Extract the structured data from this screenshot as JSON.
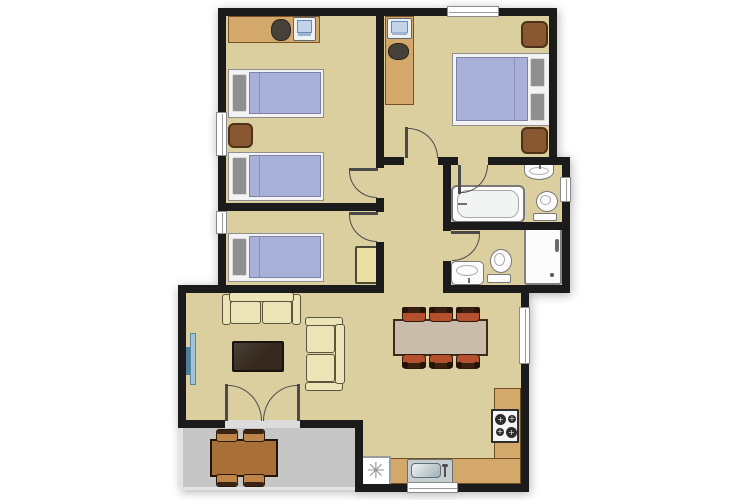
{
  "meta": {
    "view": "apartment-floor-plan",
    "canvas": {
      "width": 750,
      "height": 500
    }
  },
  "palette": {
    "floor": "#dbcfa0",
    "wall": "#1b1b1b",
    "patio": "#c6c6c6",
    "door_line": "#4a4a4a",
    "threshold": "#dcdcdc",
    "bed_duvet": "#a9b0d8",
    "bed_pillow": "#8f8f8f",
    "bed_frame": "#f3f3f3",
    "wood": "#d4a76a",
    "nightstand": "#8a5733",
    "cabinet": "#eae0a4",
    "sofa": "#ece4b6",
    "coffee_table": "#35291f",
    "dining_table_wood": "#cabcab",
    "dining_chair": "#b5502f",
    "patio_table_wood": "#a86f38",
    "patio_chair": "#bf8448",
    "fixture": "#fcfcfc",
    "fixture_line": "#787878",
    "tv_light": "#9fc6d8",
    "tv_dark": "#4f7f9f",
    "sink_metal": "#c7ced1"
  },
  "icons": {
    "freezer": "freezer-asterisk-icon"
  },
  "rooms": [
    {
      "name": "bedroom-1",
      "kind": "room",
      "rect": [
        226,
        16,
        150,
        187
      ]
    },
    {
      "name": "bedroom-2",
      "kind": "room",
      "rect": [
        226,
        211,
        150,
        74
      ]
    },
    {
      "name": "master-bedroom",
      "kind": "room",
      "rect": [
        384,
        16,
        165,
        141
      ]
    },
    {
      "name": "hallway",
      "kind": "room",
      "rect": [
        384,
        165,
        59,
        128
      ]
    },
    {
      "name": "ensuite-bathroom",
      "kind": "room",
      "rect": [
        451,
        165,
        111,
        57
      ]
    },
    {
      "name": "bathroom",
      "kind": "room",
      "rect": [
        451,
        230,
        111,
        55
      ]
    },
    {
      "name": "living-dining-room",
      "kind": "room",
      "rect": [
        186,
        293,
        335,
        127
      ]
    },
    {
      "name": "kitchen",
      "kind": "room",
      "rect": [
        363,
        420,
        158,
        64
      ]
    },
    {
      "name": "patio",
      "kind": "patio",
      "rect": [
        180,
        428,
        175,
        62
      ]
    }
  ],
  "walls": [
    {
      "name": "outer-top",
      "rect": [
        218,
        8,
        339,
        8
      ]
    },
    {
      "name": "outer-left",
      "rect": [
        218,
        8,
        8,
        285
      ]
    },
    {
      "name": "master-east",
      "rect": [
        549,
        8,
        8,
        154
      ]
    },
    {
      "name": "master-south",
      "rect": [
        376,
        157,
        194,
        8
      ]
    },
    {
      "name": "bath-east",
      "rect": [
        562,
        157,
        8,
        136
      ]
    },
    {
      "name": "bath-south",
      "rect": [
        443,
        285,
        127,
        8
      ]
    },
    {
      "name": "hall-west",
      "rect": [
        376,
        8,
        8,
        285
      ]
    },
    {
      "name": "bedroom-divider",
      "rect": [
        226,
        203,
        150,
        8
      ]
    },
    {
      "name": "living-north",
      "rect": [
        178,
        285,
        206,
        8
      ]
    },
    {
      "name": "living-west",
      "rect": [
        178,
        285,
        8,
        143
      ]
    },
    {
      "name": "living-south",
      "rect": [
        178,
        420,
        185,
        8
      ]
    },
    {
      "name": "kitchen-step",
      "rect": [
        355,
        420,
        8,
        72
      ]
    },
    {
      "name": "kitchen-south",
      "rect": [
        355,
        484,
        174,
        8
      ]
    },
    {
      "name": "east-lower",
      "rect": [
        521,
        285,
        8,
        207
      ]
    },
    {
      "name": "bath-west",
      "rect": [
        443,
        165,
        8,
        120
      ]
    },
    {
      "name": "bath-divider",
      "rect": [
        451,
        222,
        111,
        8
      ]
    }
  ],
  "windows": [
    {
      "name": "bedroom-1-west",
      "orient": "v",
      "rect": [
        216,
        112,
        11,
        44
      ]
    },
    {
      "name": "bedroom-2-west",
      "orient": "v",
      "rect": [
        216,
        211,
        11,
        23
      ]
    },
    {
      "name": "master-north",
      "orient": "h",
      "rect": [
        447,
        6,
        52,
        11
      ]
    },
    {
      "name": "ensuite-east",
      "orient": "v",
      "rect": [
        560,
        177,
        11,
        25
      ]
    },
    {
      "name": "dining-east",
      "orient": "v",
      "rect": [
        519,
        307,
        11,
        57
      ]
    },
    {
      "name": "kitchen-south",
      "orient": "h",
      "rect": [
        407,
        482,
        51,
        11
      ]
    }
  ],
  "doors": [
    {
      "name": "bedroom-1",
      "gap": [
        376,
        168,
        8,
        30
      ],
      "leaf": [
        349,
        168,
        29,
        3
      ],
      "arc": [
        349,
        171,
        28,
        27
      ],
      "corner": "bl"
    },
    {
      "name": "bedroom-2",
      "gap": [
        376,
        212,
        8,
        30
      ],
      "leaf": [
        349,
        212,
        29,
        3
      ],
      "arc": [
        349,
        215,
        28,
        27
      ],
      "corner": "bl"
    },
    {
      "name": "master-bedroom",
      "gap": [
        404,
        157,
        34,
        8
      ],
      "leaf": [
        405,
        127,
        3,
        31
      ],
      "arc": [
        408,
        128,
        30,
        30
      ],
      "corner": "tr"
    },
    {
      "name": "ensuite",
      "gap": [
        458,
        157,
        30,
        8
      ],
      "leaf": [
        458,
        165,
        3,
        29
      ],
      "arc": [
        461,
        165,
        27,
        28
      ],
      "corner": "br"
    },
    {
      "name": "bathroom",
      "gap": [
        443,
        231,
        8,
        30
      ],
      "leaf": [
        451,
        231,
        29,
        3
      ],
      "arc": [
        452,
        234,
        28,
        27
      ],
      "corner": "br"
    },
    {
      "name": "patio-french-left",
      "gap": [
        225,
        420,
        75,
        8
      ],
      "gap_color": "#dcdcdc",
      "leaf": [
        225,
        384,
        3,
        37
      ],
      "arc": [
        228,
        385,
        34,
        36
      ],
      "corner": "tr"
    },
    {
      "name": "patio-french-right",
      "gap": null,
      "leaf": [
        297,
        384,
        3,
        37
      ],
      "arc": [
        263,
        385,
        34,
        36
      ],
      "corner": "tl"
    }
  ],
  "furniture": [
    {
      "type": "desk",
      "name": "desk-bedroom-1",
      "rect": [
        228,
        16,
        92,
        27
      ],
      "opts": {
        "lines": "h"
      }
    },
    {
      "type": "computer",
      "name": "computer-bedroom-1",
      "rect": [
        293,
        17,
        23,
        24
      ],
      "opts": {}
    },
    {
      "type": "chair-blob",
      "name": "desk-chair-bedroom-1",
      "rect": [
        271,
        19,
        20,
        22
      ],
      "opts": {}
    },
    {
      "type": "bed-single",
      "name": "single-bed-1",
      "rect": [
        228,
        69,
        96,
        49
      ],
      "opts": {}
    },
    {
      "type": "nightstand",
      "name": "nightstand-bedroom-1",
      "rect": [
        228,
        123,
        25,
        25
      ],
      "opts": {}
    },
    {
      "type": "bed-single",
      "name": "single-bed-2",
      "rect": [
        228,
        152,
        96,
        49
      ],
      "opts": {}
    },
    {
      "type": "bed-single",
      "name": "single-bed-3",
      "rect": [
        228,
        233,
        96,
        49
      ],
      "opts": {}
    },
    {
      "type": "cabinet",
      "name": "cabinet-bedroom-2",
      "rect": [
        355,
        246,
        25,
        38
      ],
      "opts": {}
    },
    {
      "type": "desk",
      "name": "desk-master",
      "rect": [
        385,
        16,
        29,
        89
      ],
      "opts": {
        "lines": "h"
      }
    },
    {
      "type": "computer",
      "name": "computer-master",
      "rect": [
        387,
        18,
        25,
        21
      ],
      "opts": {}
    },
    {
      "type": "chair-blob",
      "name": "desk-chair-master",
      "rect": [
        388,
        43,
        21,
        17
      ],
      "opts": {}
    },
    {
      "type": "bed-double",
      "name": "double-bed",
      "rect": [
        452,
        53,
        98,
        73
      ],
      "opts": {}
    },
    {
      "type": "nightstand",
      "name": "nightstand-master-north",
      "rect": [
        521,
        21,
        27,
        27
      ],
      "opts": {}
    },
    {
      "type": "nightstand",
      "name": "nightstand-master-south",
      "rect": [
        521,
        127,
        27,
        27
      ],
      "opts": {}
    },
    {
      "type": "bathtub",
      "name": "bathtub",
      "rect": [
        451,
        185,
        74,
        38
      ],
      "opts": {}
    },
    {
      "type": "sink-wall",
      "name": "ensuite-sink",
      "rect": [
        524,
        163,
        30,
        17
      ],
      "opts": {}
    },
    {
      "type": "toilet",
      "name": "ensuite-toilet",
      "rect": [
        533,
        191,
        27,
        32
      ],
      "opts": {}
    },
    {
      "type": "shower",
      "name": "shower",
      "rect": [
        524,
        228,
        38,
        57
      ],
      "opts": {}
    },
    {
      "type": "toilet",
      "name": "bathroom-toilet",
      "rect": [
        487,
        249,
        27,
        36
      ],
      "opts": {}
    },
    {
      "type": "sink-pedestal",
      "name": "bathroom-sink",
      "rect": [
        451,
        261,
        33,
        24
      ],
      "opts": {}
    },
    {
      "type": "sofa",
      "name": "sofa-main",
      "rect": [
        222,
        292,
        79,
        35
      ],
      "opts": {
        "back": "top"
      }
    },
    {
      "type": "sofa",
      "name": "sofa-side",
      "rect": [
        303,
        317,
        42,
        74
      ],
      "opts": {
        "back": "right"
      }
    },
    {
      "type": "block",
      "name": "tv-screen",
      "rect": [
        186,
        347,
        4,
        28
      ],
      "opts": {
        "color": "#4f7f9f"
      }
    },
    {
      "type": "block",
      "name": "tv-unit",
      "rect": [
        190,
        333,
        6,
        52
      ],
      "opts": {
        "color": "#9fc6d8",
        "border": "#5a87a0"
      }
    },
    {
      "type": "coffee-table",
      "name": "coffee-table",
      "rect": [
        232,
        341,
        52,
        31
      ],
      "opts": {}
    },
    {
      "type": "dining-table",
      "name": "dining-table",
      "rect": [
        393,
        319,
        95,
        37
      ],
      "opts": {}
    },
    {
      "type": "chair-dining",
      "name": "dining-chair-1",
      "rect": [
        402,
        307,
        24,
        15
      ],
      "opts": {
        "cap": "top"
      }
    },
    {
      "type": "chair-dining",
      "name": "dining-chair-2",
      "rect": [
        429,
        307,
        24,
        15
      ],
      "opts": {
        "cap": "top"
      }
    },
    {
      "type": "chair-dining",
      "name": "dining-chair-3",
      "rect": [
        456,
        307,
        24,
        15
      ],
      "opts": {
        "cap": "top"
      }
    },
    {
      "type": "chair-dining",
      "name": "dining-chair-4",
      "rect": [
        402,
        354,
        24,
        15
      ],
      "opts": {
        "cap": "bottom"
      }
    },
    {
      "type": "chair-dining",
      "name": "dining-chair-5",
      "rect": [
        429,
        354,
        24,
        15
      ],
      "opts": {
        "cap": "bottom"
      }
    },
    {
      "type": "chair-dining",
      "name": "dining-chair-6",
      "rect": [
        456,
        354,
        24,
        15
      ],
      "opts": {
        "cap": "bottom"
      }
    },
    {
      "type": "counter",
      "name": "kitchen-counter-east",
      "rect": [
        494,
        388,
        27,
        71
      ],
      "opts": {
        "lines": "h"
      }
    },
    {
      "type": "counter",
      "name": "kitchen-counter-south",
      "rect": [
        389,
        458,
        132,
        26
      ],
      "opts": {
        "lines": "v"
      }
    },
    {
      "type": "stove",
      "name": "stove",
      "rect": [
        491,
        409,
        28,
        34
      ],
      "opts": {}
    },
    {
      "type": "kitchen-sink",
      "name": "kitchen-sink",
      "rect": [
        407,
        459,
        46,
        25
      ],
      "opts": {}
    },
    {
      "type": "freezer",
      "name": "freezer",
      "rect": [
        361,
        456,
        30,
        31
      ],
      "opts": {
        "glyph": "✳"
      }
    },
    {
      "type": "patio-table",
      "name": "patio-table",
      "rect": [
        210,
        439,
        68,
        38
      ],
      "opts": {}
    },
    {
      "type": "chair-patio",
      "name": "patio-chair-1",
      "rect": [
        216,
        429,
        22,
        13
      ],
      "opts": {
        "cap": "top"
      }
    },
    {
      "type": "chair-patio",
      "name": "patio-chair-2",
      "rect": [
        243,
        429,
        22,
        13
      ],
      "opts": {
        "cap": "top"
      }
    },
    {
      "type": "chair-patio",
      "name": "patio-chair-3",
      "rect": [
        216,
        474,
        22,
        13
      ],
      "opts": {
        "cap": "bottom"
      }
    },
    {
      "type": "chair-patio",
      "name": "patio-chair-4",
      "rect": [
        243,
        474,
        22,
        13
      ],
      "opts": {
        "cap": "bottom"
      }
    }
  ]
}
